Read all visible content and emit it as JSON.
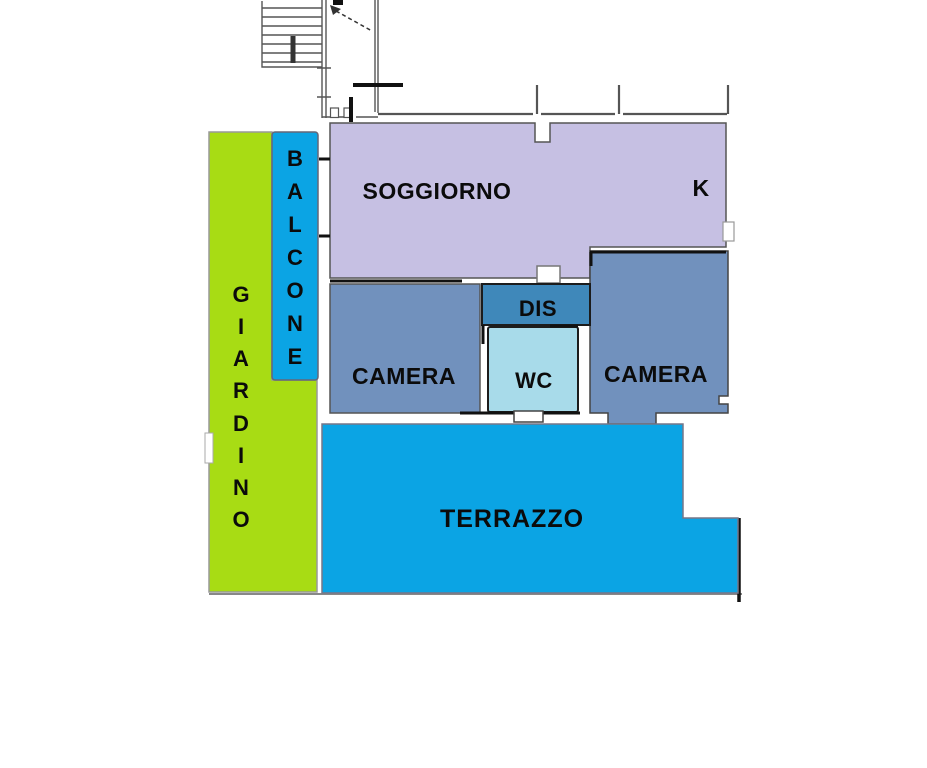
{
  "plan": {
    "type": "apartment-floor-plan",
    "rooms": {
      "soggiorno": {
        "label": "SOGGIORNO"
      },
      "kitchen": {
        "label": "K"
      },
      "camera_left": {
        "label": "CAMERA"
      },
      "camera_right": {
        "label": "CAMERA"
      },
      "dis": {
        "label": "DIS"
      },
      "wc": {
        "label": "WC"
      },
      "terrazzo": {
        "label": "TERRAZZO"
      },
      "balcone": {
        "label": "BALCONE",
        "letters": [
          "B",
          "A",
          "L",
          "C",
          "O",
          "N",
          "E"
        ]
      },
      "giardino": {
        "label": "GIARDINO",
        "letters": [
          "G",
          "I",
          "A",
          "R",
          "D",
          "I",
          "N",
          "O"
        ]
      }
    },
    "colors": {
      "soggiorno": "#c6c0e3",
      "camera": "#7191bd",
      "dis": "#3f88ba",
      "wc": "#a8dbea",
      "terrace_blue": "#0ba4e4",
      "garden_green": "#a8dc14"
    }
  }
}
